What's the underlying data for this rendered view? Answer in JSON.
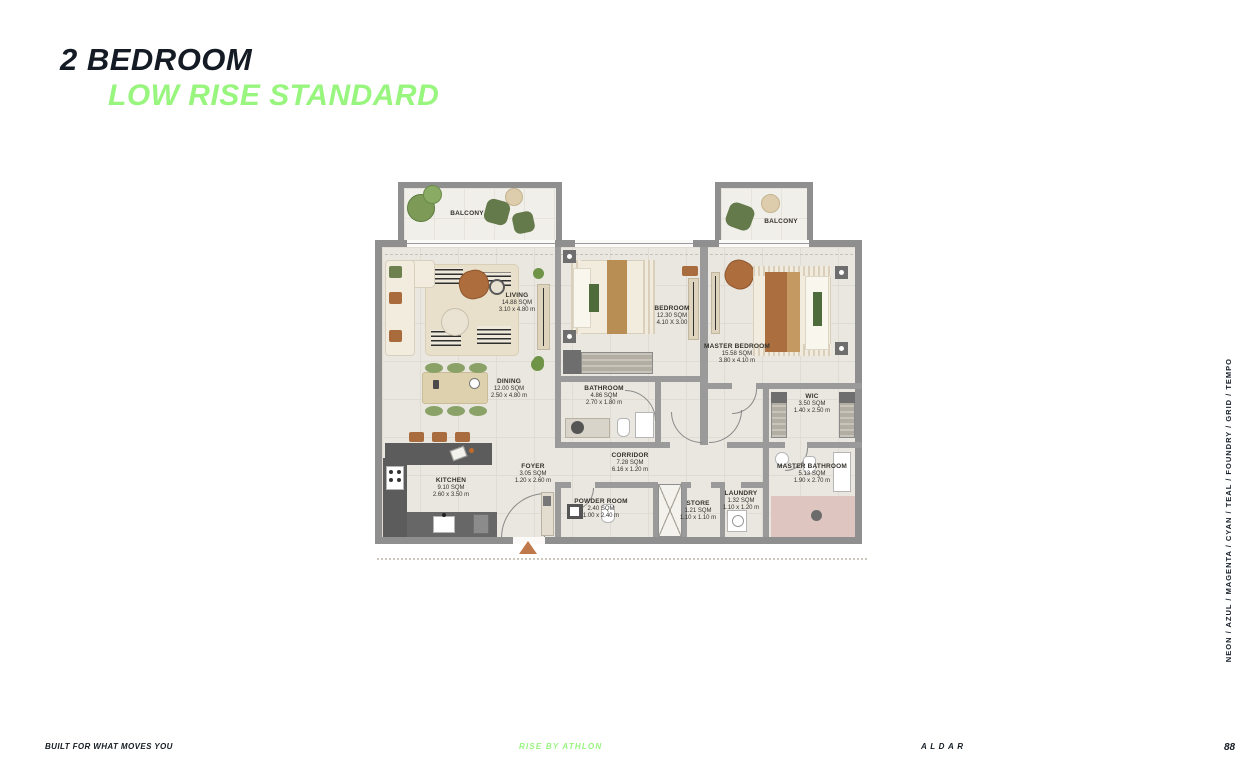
{
  "header": {
    "title": "2 BEDROOM",
    "subtitle": "LOW RISE STANDARD"
  },
  "floorplan": {
    "rooms": [
      {
        "name": "BALCONY",
        "area": "",
        "dims": ""
      },
      {
        "name": "BALCONY",
        "area": "",
        "dims": ""
      },
      {
        "name": "LIVING",
        "area": "14.88 SQM",
        "dims": "3.10 x 4.80 m"
      },
      {
        "name": "BEDROOM",
        "area": "12.30 SQM",
        "dims": "4.10 X 3.00"
      },
      {
        "name": "MASTER BEDROOM",
        "area": "15.58 SQM",
        "dims": "3.80 x 4.10 m"
      },
      {
        "name": "DINING",
        "area": "12.00 SQM",
        "dims": "2.50 x 4.80 m"
      },
      {
        "name": "BATHROOM",
        "area": "4.86 SQM",
        "dims": "2.70 x 1.80 m"
      },
      {
        "name": "WIC",
        "area": "3.50 SQM",
        "dims": "1.40 x 2.50 m"
      },
      {
        "name": "KITCHEN",
        "area": "9.10 SQM",
        "dims": "2.60 x 3.50 m"
      },
      {
        "name": "FOYER",
        "area": "3.05 SQM",
        "dims": "1.20 x 2.60 m"
      },
      {
        "name": "CORRIDOR",
        "area": "7.28 SQM",
        "dims": "6.16 x 1.20 m"
      },
      {
        "name": "MASTER BATHROOM",
        "area": "5.13 SQM",
        "dims": "1.90 x 2.70 m"
      },
      {
        "name": "POWDER ROOM",
        "area": "2.40 SQM",
        "dims": "1.00 x 2.40 m"
      },
      {
        "name": "STORE",
        "area": "1.21 SQM",
        "dims": "1.10 x 1.10 m"
      },
      {
        "name": "LAUNDRY",
        "area": "1.32 SQM",
        "dims": "1.10 x 1.20 m"
      }
    ],
    "icons": {
      "entrance_arrow": "▲"
    }
  },
  "sidebar": {
    "text": "NEON / AZUL / MAGENTA / CYAN / TEAL / FOUNDRY / GRID / TEMPO"
  },
  "footer": {
    "tagline": "BUILT FOR WHAT MOVES YOU",
    "brand_center": "RISE BY ATHLON",
    "brand_right": "ALDAR",
    "page_number": "88"
  },
  "colors": {
    "accent_green": "#98F57E",
    "ink": "#141B24",
    "wall_gray": "#8F8F8F",
    "floor_beige": "#EAE7E0",
    "bath_pink": "#DFC5C0",
    "entrance_arrow": "#BF7849"
  }
}
